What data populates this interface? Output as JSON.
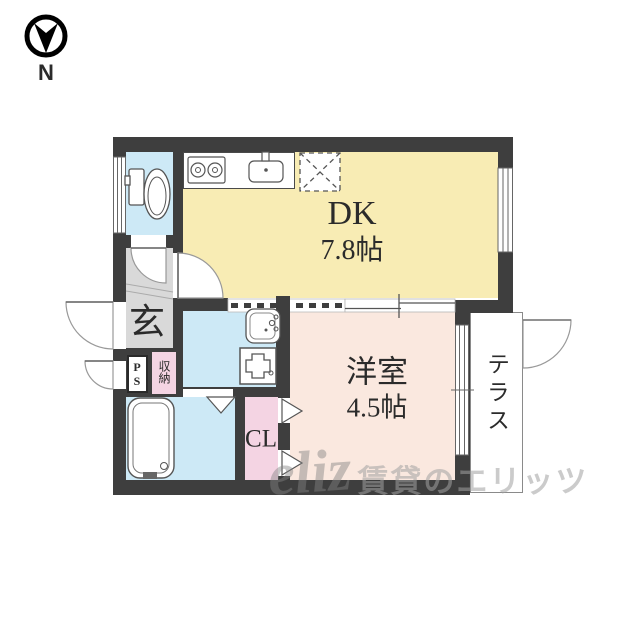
{
  "compass": {
    "label": "N"
  },
  "rooms": {
    "dk": {
      "label": "DK",
      "size": "7.8帖"
    },
    "western": {
      "label": "洋室",
      "size": "4.5帖"
    },
    "terrace": {
      "label": "テラス"
    },
    "entrance": {
      "label": "玄"
    },
    "closet": {
      "label": "CL"
    },
    "storage": {
      "label": "収納"
    },
    "pipe_space": {
      "label": "PS"
    }
  },
  "watermark": {
    "logo": "eliz",
    "text": "賃貸のエリッツ"
  },
  "colors": {
    "wall": "#3e3e3e",
    "dk_floor": "#f8ecb4",
    "western_floor": "#fae8df",
    "water_floor": "#cde9f6",
    "closet_floor": "#f4d4e3",
    "entrance_floor": "#d9d9d9",
    "terrace_border": "#8a8a8a"
  }
}
